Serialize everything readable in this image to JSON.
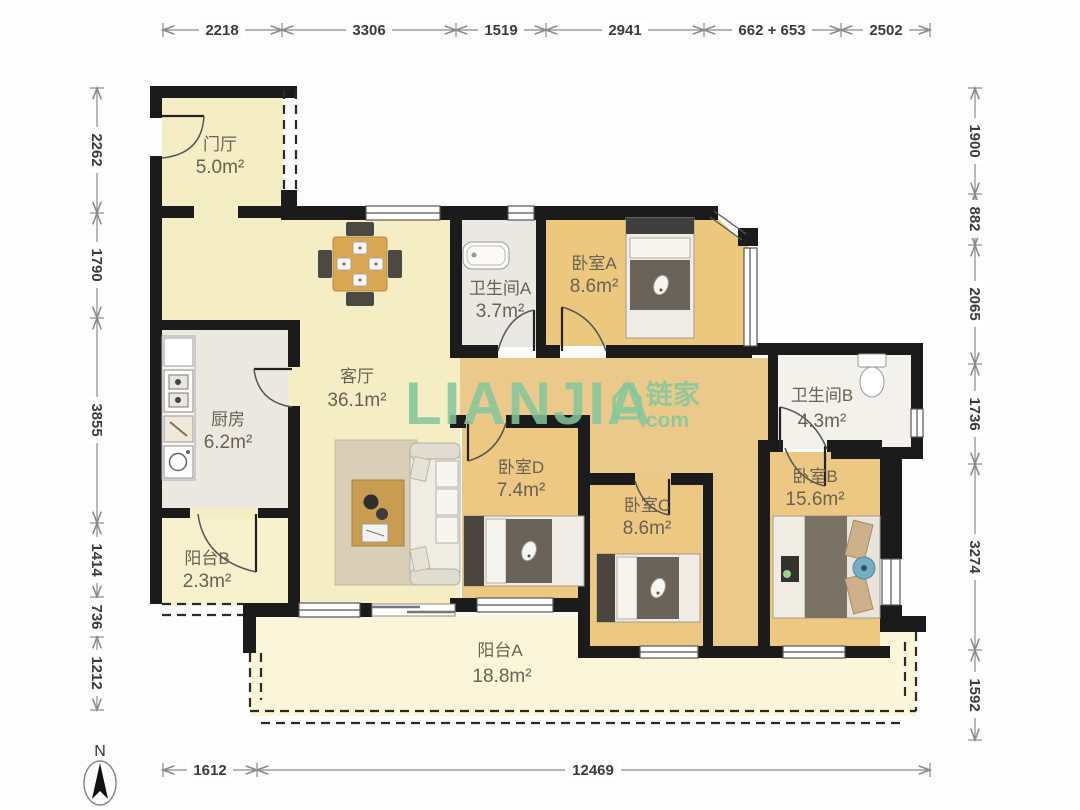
{
  "watermark": {
    "brand": "LIANJIA",
    "cn": "链家",
    "domain": ".com"
  },
  "compass": {
    "north_label": "N"
  },
  "rooms": {
    "entry": {
      "name": "门厅",
      "area": "5.0m²"
    },
    "living": {
      "name": "客厅",
      "area": "36.1m²"
    },
    "kitchen": {
      "name": "厨房",
      "area": "6.2m²"
    },
    "balcony_b": {
      "name": "阳台B",
      "area": "2.3m²"
    },
    "bath_a": {
      "name": "卫生间A",
      "area": "3.7m²"
    },
    "bed_a": {
      "name": "卧室A",
      "area": "8.6m²"
    },
    "bath_b": {
      "name": "卫生间B",
      "area": "4.3m²"
    },
    "bed_d": {
      "name": "卧室D",
      "area": "7.4m²"
    },
    "bed_c": {
      "name": "卧室C",
      "area": "8.6m²"
    },
    "bed_b": {
      "name": "卧室B",
      "area": "15.6m²"
    },
    "balcony_a": {
      "name": "阳台A",
      "area": "18.8m²"
    }
  },
  "dimensions": {
    "top": [
      "2218",
      "3306",
      "1519",
      "2941",
      "662 + 653",
      "2502"
    ],
    "left": [
      "2262",
      "1790",
      "3855",
      "1414",
      "736",
      "1212"
    ],
    "right": [
      "1900",
      "882",
      "2065",
      "1736",
      "3274",
      "1592"
    ],
    "bottom": [
      "1612",
      "12469"
    ]
  },
  "colors": {
    "wall": "#1b1b1b",
    "pale_yellow_floor": "#f5eec5",
    "wood_floor": "#ecc883",
    "tile_floor": "#eae8e1",
    "balcony_floor": "#fbf6da",
    "watermark_green": "#82c79c"
  }
}
